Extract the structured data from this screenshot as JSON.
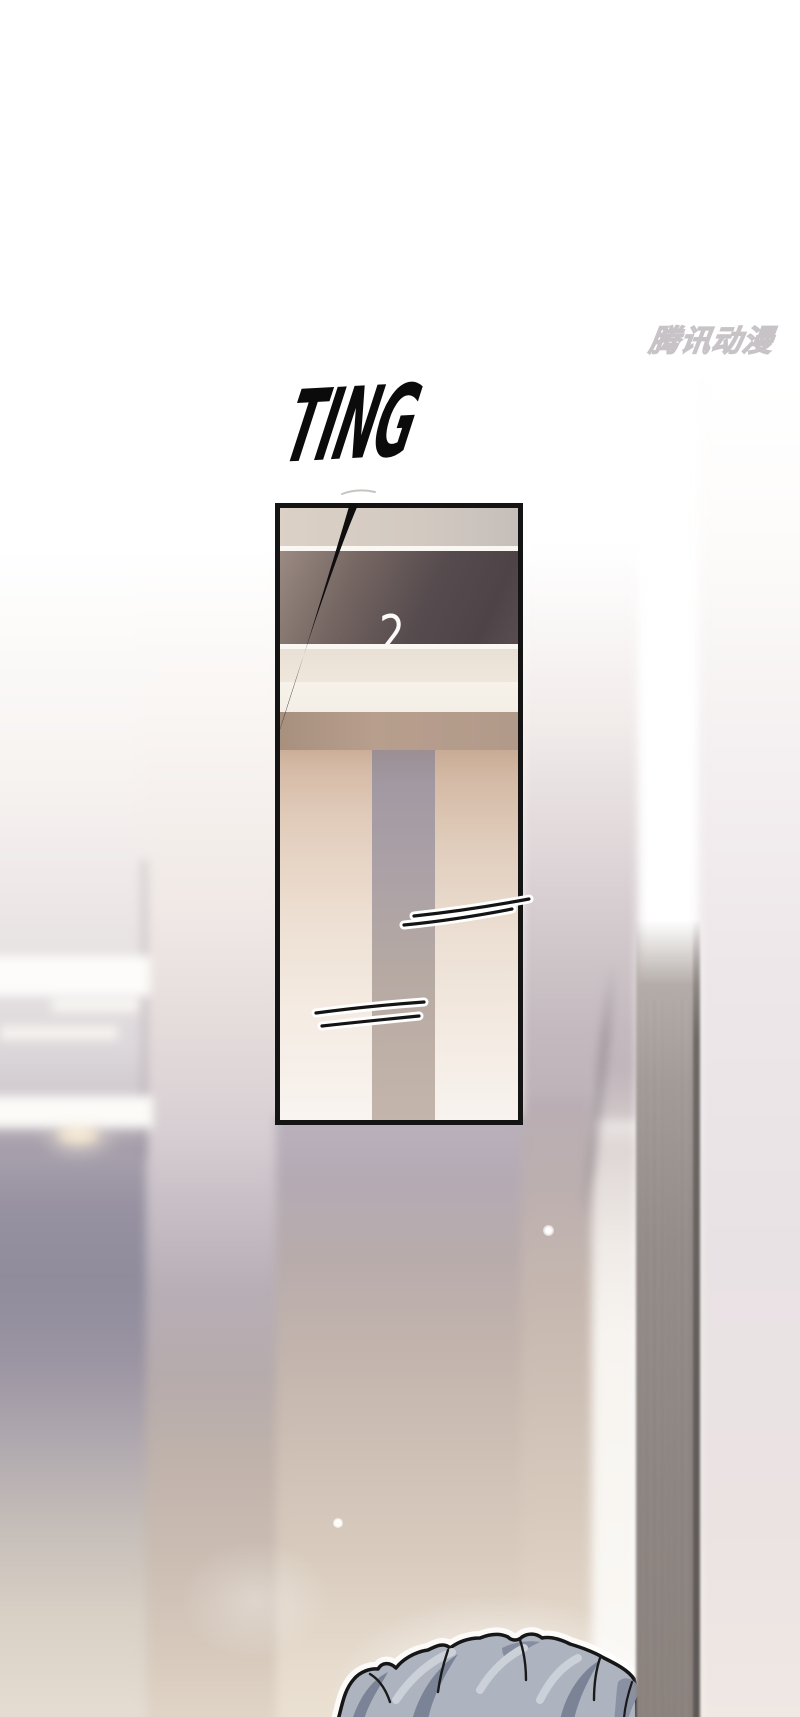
{
  "page": {
    "width": 800,
    "height": 1717
  },
  "watermark": {
    "text": "腾讯动漫"
  },
  "sfx_ting": {
    "text": "TING"
  },
  "elevator": {
    "floor_indicator": "2"
  },
  "colors": {
    "sfx_text": "#0b0b0b",
    "panel_border": "#141414",
    "indicator_band": "#564b4e",
    "floor_number": "#fcfbfa",
    "elevator_door": "#eddfd2",
    "door_gap": "#aca2a6",
    "watermark_outline": "#c7c3c6",
    "hair_base": "#adb3bf",
    "hair_shadow": "#7b8396",
    "hair_highlight": "#ccd0d8",
    "pillar": "#948c88",
    "hall_wall_beige": "#cbbeb3",
    "hall_wall_lavender": "#b3abb6"
  }
}
